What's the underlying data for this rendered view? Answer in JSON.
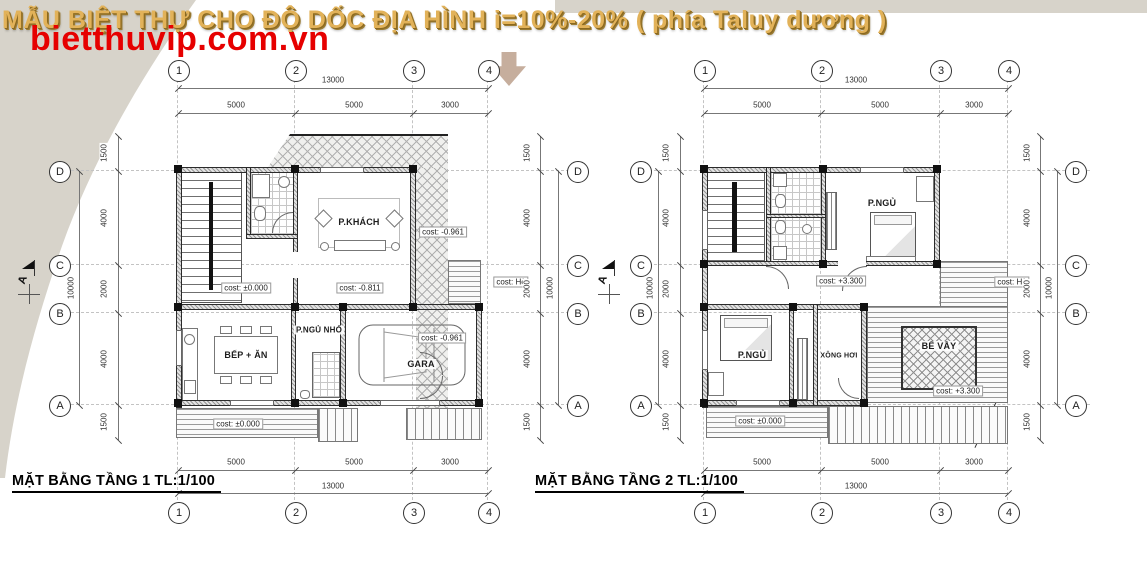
{
  "header": {
    "title": "MẪU BIỆT THỰ CHO ĐỘ DỐC ĐỊA HÌNH i=10%-20% ( phía Taluy dương )",
    "watermark": "bietthuvip.com.vn"
  },
  "grid": {
    "columns": [
      "1",
      "2",
      "3",
      "4"
    ],
    "rows": [
      "D",
      "C",
      "B",
      "A"
    ],
    "col_spans": [
      "5000",
      "5000",
      "3000"
    ],
    "col_total": "13000",
    "row_spans": [
      "1500",
      "4000",
      "2000",
      "4000",
      "1500"
    ],
    "row_total": "10000",
    "section_label": "A"
  },
  "plans": [
    {
      "title": "MẶT BẰNG TẦNG 1 TL:1/100",
      "rooms": {
        "living": "P.KHÁCH",
        "kitchen": "BẾP + ĂN",
        "small_bedroom": "P.NGỦ NHỎ",
        "garage": "GARA"
      },
      "costs": {
        "hall": "cost: ±0.000",
        "living": "cost: -0.811",
        "walkway": "cost: -0.961",
        "garage": "cost: -0.961",
        "terrace": "cost: ±0.000",
        "sidewalk": "cost: Hè"
      }
    },
    {
      "title": "MẶT BẰNG TẦNG 2 TL:1/100",
      "rooms": {
        "bedroom1": "P.NGỦ",
        "bedroom2": "P.NGỦ",
        "sauna": "XÔNG HƠI",
        "pool": "BỂ VẦY"
      },
      "costs": {
        "floor": "cost: +3.300",
        "pool_deck": "cost: +3.300",
        "terrace": "cost: ±0.000",
        "sidewalk": "cost: Hè"
      }
    }
  ]
}
